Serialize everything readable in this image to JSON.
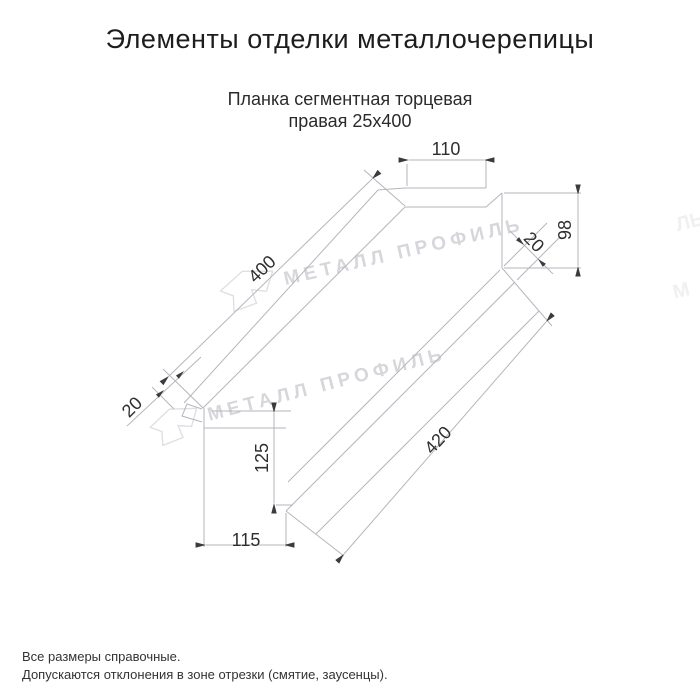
{
  "title": {
    "text": "Элементы отделки металлочерепицы"
  },
  "subtitle": {
    "line1": "Планка сегментная торцевая",
    "line2": "правая 25х400"
  },
  "drawing": {
    "kind": "technical-dimension-drawing",
    "dims": {
      "top_width": "110",
      "end_height": "98",
      "end_hem": "20",
      "length_top": "400",
      "length_bottom": "420",
      "cut_hem": "20",
      "side_height": "125",
      "bottom_width": "115"
    }
  },
  "watermark": {
    "text": "МЕТАЛЛ ПРОФИЛЬ",
    "logo": "metal-profil-arrow-logo",
    "fragments": [
      {
        "text": "ЛЬ"
      },
      {
        "text": "М"
      }
    ]
  },
  "footer": {
    "line1": "Все размеры справочные.",
    "line2": "Допускаются отклонения в зоне отрезки (смятие, заусенцы)."
  },
  "colors": {
    "background": "#ffffff",
    "line": "#b5b6bd",
    "dim_arrow": "#3b3b3b",
    "dim_text": "#2e2e30",
    "title_text": "#1d1d1f",
    "watermark_text": "#d6d7db",
    "watermark_logo": "#dfdfe3",
    "footer_text": "#333333"
  }
}
